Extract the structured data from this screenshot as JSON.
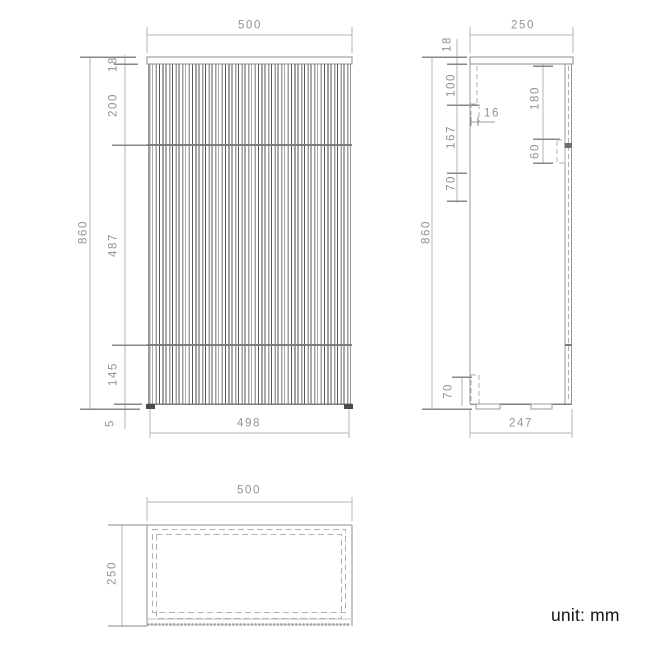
{
  "note": {
    "unit": "unit: mm"
  },
  "views": {
    "front": {
      "width_top": "500",
      "top_thickness": "18",
      "seg_upper": "200",
      "seg_middle": "487",
      "seg_lower": "145",
      "feet_gap": "5",
      "height": "860",
      "width_bottom": "498"
    },
    "side": {
      "depth_top": "250",
      "top_thickness": "18",
      "seg_a": "100",
      "seg_b": "167",
      "seg_c": "70",
      "panel_thickness": "16",
      "handle_top_offset": "180",
      "handle_height": "60",
      "height": "860",
      "foot_height": "70",
      "depth_bottom": "247"
    },
    "plan": {
      "width": "500",
      "depth": "250"
    }
  },
  "colors": {
    "background": "#ffffff",
    "outline": "#8f8f8f",
    "dimension_line": "#b5b5b5",
    "tick": "#878787",
    "dashed_hidden": "#b0b0b0",
    "flute_light": "#a0a0a0",
    "flute_dark": "#565656",
    "dim_text": "#929292",
    "note_text": "#141414"
  }
}
